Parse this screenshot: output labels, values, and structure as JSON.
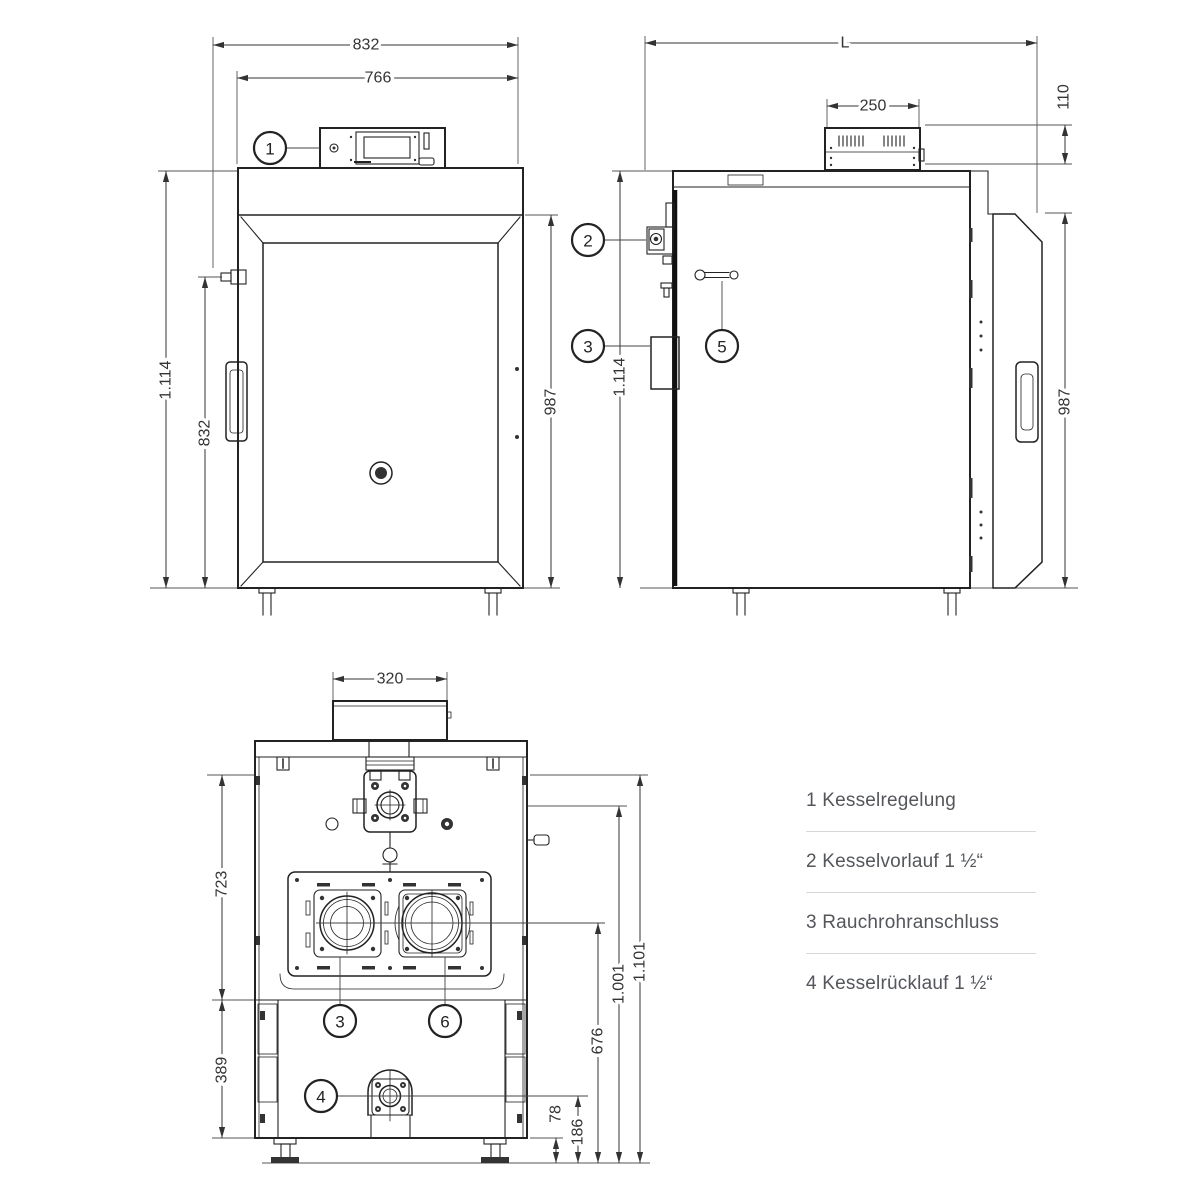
{
  "views": {
    "front": {
      "dims": {
        "width_outer": "832",
        "width_inner": "766",
        "height_total": "1.114",
        "height_door": "832",
        "height_body": "987"
      },
      "callouts": {
        "c1": "1"
      }
    },
    "side": {
      "dims": {
        "length": "L",
        "control_box_width": "250",
        "control_box_height": "110",
        "height_total": "1.114",
        "height_body": "987"
      },
      "callouts": {
        "c2": "2",
        "c3": "3",
        "c5": "5"
      }
    },
    "rear": {
      "dims": {
        "flue_collar_width": "320",
        "upper_section_height": "723",
        "lower_section_height": "389",
        "total_height": "1.101",
        "vorlauf_height": "1.001",
        "flue_center_height": "676",
        "ruecklauf_center_height": "186",
        "bottom_offset": "78"
      },
      "callouts": {
        "c3": "3",
        "c6": "6",
        "c4": "4"
      }
    }
  },
  "legend": {
    "items": [
      {
        "label": "1 Kesselregelung"
      },
      {
        "label": "2 Kesselvorlauf 1 ½“"
      },
      {
        "label": "3 Rauchrohranschluss"
      },
      {
        "label": "4 Kesselrücklauf 1 ½“"
      }
    ]
  },
  "colors": {
    "background": "#ffffff",
    "line": "#222222",
    "dim_line": "#333333",
    "legend_text": "#53565a",
    "divider": "#d8d8d8"
  }
}
